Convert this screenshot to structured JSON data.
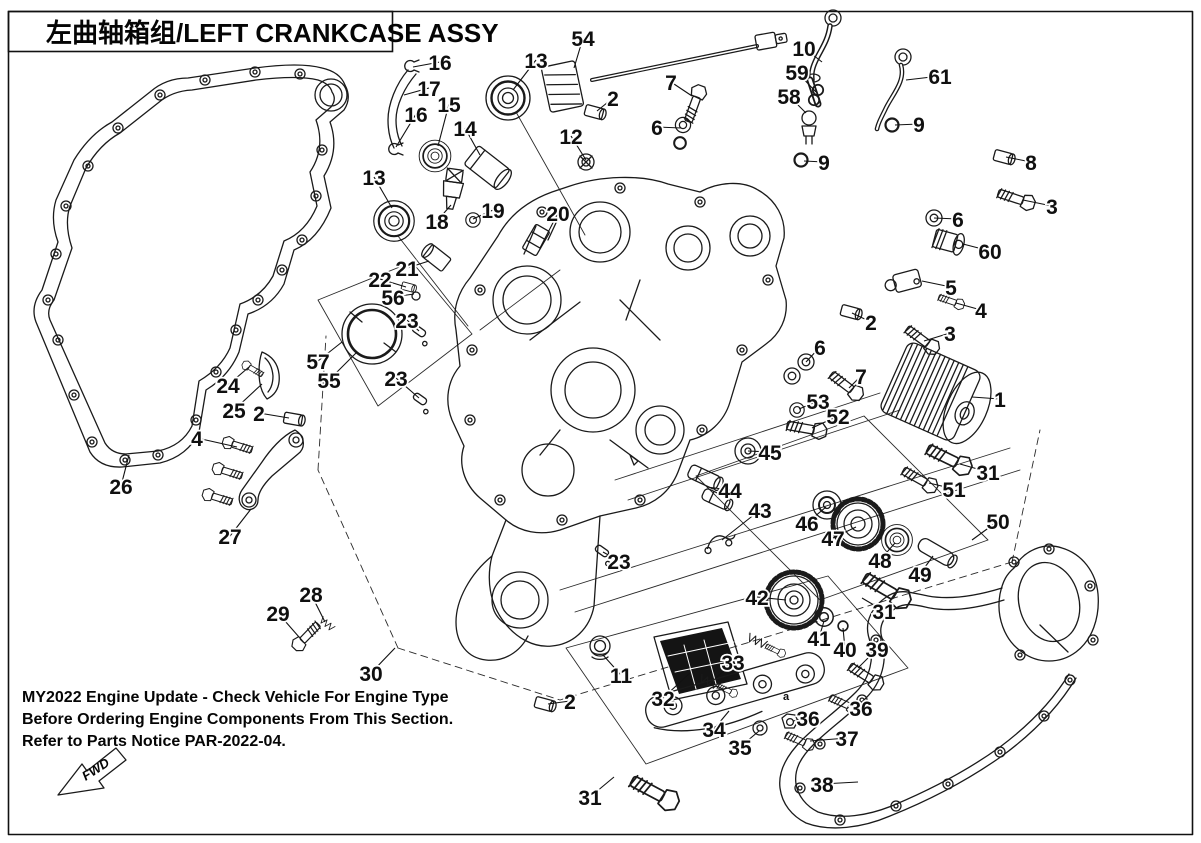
{
  "title_block": {
    "title": "左曲轴箱组/LEFT CRANKCASE ASSY"
  },
  "notice": {
    "line1": "MY2022 Engine Update - Check Vehicle For Engine Type",
    "line2": "Before Ordering Engine Components From This Section.",
    "line3": "Refer to Parts Notice PAR-2022-04."
  },
  "fwd_indicator": {
    "label": "FWD"
  },
  "colors": {
    "ink": "#1a1a1a",
    "paper": "#ffffff",
    "strainer_fill": "#141414"
  },
  "diagram": {
    "description": "Exploded parts view of left crankcase assembly with numbered callouts",
    "annotations": [
      {
        "text": "a",
        "x": 786,
        "y": 700
      }
    ],
    "callouts": [
      {
        "label": "16",
        "x": 440,
        "y": 62,
        "tx": 413,
        "ty": 67
      },
      {
        "label": "17",
        "x": 429,
        "y": 88,
        "tx": 404,
        "ty": 95
      },
      {
        "label": "15",
        "x": 449,
        "y": 104,
        "tx": 438,
        "ty": 146
      },
      {
        "label": "16",
        "x": 416,
        "y": 114,
        "tx": 396,
        "ty": 147
      },
      {
        "label": "13",
        "x": 536,
        "y": 60,
        "tx": 513,
        "ty": 90
      },
      {
        "label": "14",
        "x": 465,
        "y": 128,
        "tx": 480,
        "ty": 155
      },
      {
        "label": "54",
        "x": 583,
        "y": 38,
        "tx": 574,
        "ty": 68
      },
      {
        "label": "2",
        "x": 613,
        "y": 98,
        "tx": 597,
        "ty": 111
      },
      {
        "label": "7",
        "x": 671,
        "y": 82,
        "tx": 692,
        "ty": 96
      },
      {
        "label": "12",
        "x": 571,
        "y": 136,
        "tx": 586,
        "ty": 160
      },
      {
        "label": "6",
        "x": 657,
        "y": 127,
        "tx": 681,
        "ty": 128
      },
      {
        "label": "13",
        "x": 374,
        "y": 177,
        "tx": 392,
        "ty": 208
      },
      {
        "label": "18",
        "x": 437,
        "y": 221,
        "tx": 451,
        "ty": 205
      },
      {
        "label": "19",
        "x": 493,
        "y": 210,
        "tx": 473,
        "ty": 219
      },
      {
        "label": "20",
        "x": 558,
        "y": 213,
        "tx": 540,
        "ty": 248
      },
      {
        "label": "10",
        "x": 804,
        "y": 48,
        "tx": 822,
        "ty": 62
      },
      {
        "label": "59",
        "x": 797,
        "y": 72,
        "tx": 816,
        "ty": 92
      },
      {
        "label": "58",
        "x": 789,
        "y": 96,
        "tx": 806,
        "ty": 113
      },
      {
        "label": "61",
        "x": 940,
        "y": 76,
        "tx": 906,
        "ty": 80
      },
      {
        "label": "9",
        "x": 919,
        "y": 124,
        "tx": 895,
        "ty": 125
      },
      {
        "label": "9",
        "x": 824,
        "y": 162,
        "tx": 804,
        "ty": 161
      },
      {
        "label": "8",
        "x": 1031,
        "y": 162,
        "tx": 1006,
        "ty": 157
      },
      {
        "label": "3",
        "x": 1052,
        "y": 206,
        "tx": 1023,
        "ty": 200
      },
      {
        "label": "6",
        "x": 958,
        "y": 219,
        "tx": 934,
        "ty": 218
      },
      {
        "label": "60",
        "x": 990,
        "y": 251,
        "tx": 963,
        "ty": 244
      },
      {
        "label": "5",
        "x": 951,
        "y": 287,
        "tx": 922,
        "ty": 281
      },
      {
        "label": "4",
        "x": 981,
        "y": 310,
        "tx": 956,
        "ty": 303
      },
      {
        "label": "2",
        "x": 871,
        "y": 322,
        "tx": 852,
        "ty": 313
      },
      {
        "label": "3",
        "x": 950,
        "y": 333,
        "tx": 924,
        "ty": 341
      },
      {
        "label": "6",
        "x": 820,
        "y": 347,
        "tx": 806,
        "ty": 362
      },
      {
        "label": "7",
        "x": 861,
        "y": 376,
        "tx": 849,
        "ty": 388
      },
      {
        "label": "53",
        "x": 818,
        "y": 401,
        "tx": 799,
        "ty": 409
      },
      {
        "label": "52",
        "x": 838,
        "y": 416,
        "tx": 812,
        "ty": 428
      },
      {
        "label": "1",
        "x": 1000,
        "y": 399,
        "tx": 972,
        "ty": 397
      },
      {
        "label": "45",
        "x": 770,
        "y": 452,
        "tx": 748,
        "ty": 451
      },
      {
        "label": "31",
        "x": 988,
        "y": 472,
        "tx": 960,
        "ty": 464
      },
      {
        "label": "51",
        "x": 954,
        "y": 489,
        "tx": 929,
        "ty": 483
      },
      {
        "label": "44",
        "x": 730,
        "y": 490,
        "tx": 707,
        "ty": 487
      },
      {
        "label": "43",
        "x": 760,
        "y": 510,
        "tx": 722,
        "ty": 540
      },
      {
        "label": "46",
        "x": 807,
        "y": 523,
        "tx": 826,
        "ty": 507
      },
      {
        "label": "47",
        "x": 833,
        "y": 538,
        "tx": 856,
        "ty": 527
      },
      {
        "label": "48",
        "x": 880,
        "y": 560,
        "tx": 895,
        "ty": 543
      },
      {
        "label": "49",
        "x": 920,
        "y": 574,
        "tx": 933,
        "ty": 556
      },
      {
        "label": "50",
        "x": 998,
        "y": 521,
        "tx": 972,
        "ty": 540
      },
      {
        "label": "42",
        "x": 757,
        "y": 597,
        "tx": 786,
        "ty": 600
      },
      {
        "label": "31",
        "x": 884,
        "y": 611,
        "tx": 862,
        "ty": 598
      },
      {
        "label": "41",
        "x": 819,
        "y": 638,
        "tx": 824,
        "ty": 621
      },
      {
        "label": "40",
        "x": 845,
        "y": 649,
        "tx": 843,
        "ty": 628
      },
      {
        "label": "39",
        "x": 877,
        "y": 649,
        "tx": 858,
        "ty": 668
      },
      {
        "label": "23",
        "x": 407,
        "y": 320,
        "tx": 419,
        "ty": 331
      },
      {
        "label": "21",
        "x": 407,
        "y": 268,
        "tx": 429,
        "ty": 261
      },
      {
        "label": "22",
        "x": 380,
        "y": 279,
        "tx": 406,
        "ty": 287
      },
      {
        "label": "56",
        "x": 393,
        "y": 297,
        "tx": 414,
        "ty": 294
      },
      {
        "label": "57",
        "x": 318,
        "y": 361,
        "tx": 342,
        "ty": 342
      },
      {
        "label": "55",
        "x": 329,
        "y": 380,
        "tx": 357,
        "ty": 352
      },
      {
        "label": "23",
        "x": 396,
        "y": 378,
        "tx": 419,
        "ty": 398
      },
      {
        "label": "24",
        "x": 228,
        "y": 385,
        "tx": 249,
        "ty": 367
      },
      {
        "label": "25",
        "x": 234,
        "y": 410,
        "tx": 262,
        "ty": 384
      },
      {
        "label": "2",
        "x": 259,
        "y": 413,
        "tx": 289,
        "ty": 418
      },
      {
        "label": "4",
        "x": 197,
        "y": 438,
        "tx": 237,
        "ty": 447
      },
      {
        "label": "26",
        "x": 121,
        "y": 486,
        "tx": 129,
        "ty": 455
      },
      {
        "label": "27",
        "x": 230,
        "y": 536,
        "tx": 251,
        "ty": 509
      },
      {
        "label": "28",
        "x": 311,
        "y": 594,
        "tx": 325,
        "ty": 622
      },
      {
        "label": "29",
        "x": 278,
        "y": 613,
        "tx": 299,
        "ty": 637
      },
      {
        "label": "30",
        "x": 371,
        "y": 673,
        "tx": 395,
        "ty": 648
      },
      {
        "label": "23",
        "x": 619,
        "y": 561,
        "tx": 603,
        "ty": 552
      },
      {
        "label": "11",
        "x": 621,
        "y": 675,
        "tx": 603,
        "ty": 655
      },
      {
        "label": "2",
        "x": 570,
        "y": 701,
        "tx": 548,
        "ty": 704
      },
      {
        "label": "32",
        "x": 663,
        "y": 698,
        "tx": 690,
        "ty": 673
      },
      {
        "label": "33",
        "x": 733,
        "y": 662,
        "tx": 716,
        "ty": 678
      },
      {
        "label": "34",
        "x": 714,
        "y": 729,
        "tx": 729,
        "ty": 711
      },
      {
        "label": "35",
        "x": 740,
        "y": 747,
        "tx": 759,
        "ty": 731
      },
      {
        "label": "36",
        "x": 808,
        "y": 718,
        "tx": 793,
        "ty": 721
      },
      {
        "label": "36",
        "x": 861,
        "y": 708,
        "tx": 849,
        "ty": 705
      },
      {
        "label": "37",
        "x": 847,
        "y": 738,
        "tx": 810,
        "ty": 741
      },
      {
        "label": "38",
        "x": 822,
        "y": 784,
        "tx": 858,
        "ty": 782
      },
      {
        "label": "31",
        "x": 590,
        "y": 797,
        "tx": 614,
        "ty": 777
      }
    ]
  }
}
